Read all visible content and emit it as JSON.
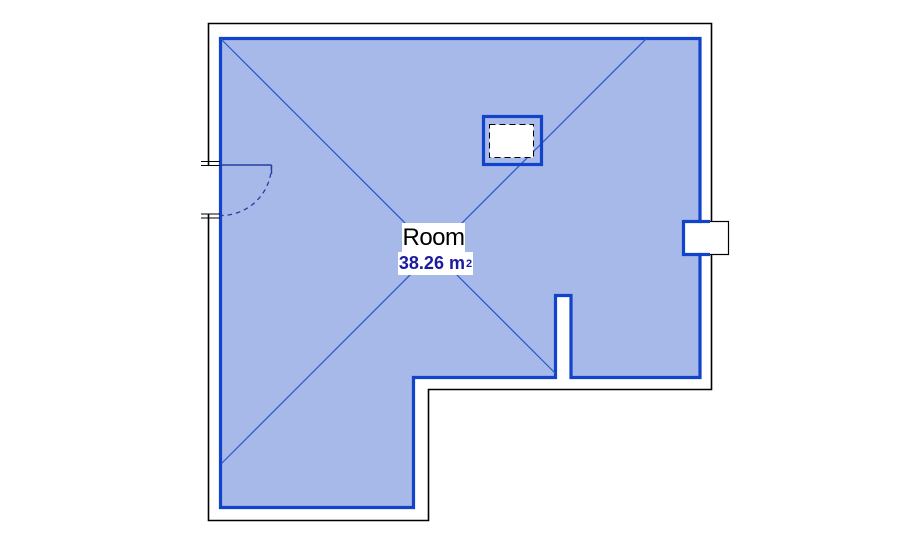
{
  "view": {
    "background_color": "#ffffff"
  },
  "room": {
    "name": "Room",
    "area_value": "38.26",
    "area_unit": "m",
    "area_sup": "2",
    "fill_color": "#a7b9e8",
    "boundary_color": "#1243cb",
    "name_text_color": "#000000",
    "area_text_color": "#1b1b9e"
  },
  "elements": {
    "wall_line_color": "#000000",
    "door_line_color": "#22409f",
    "diagonal_line_color": "#2b55cc"
  }
}
